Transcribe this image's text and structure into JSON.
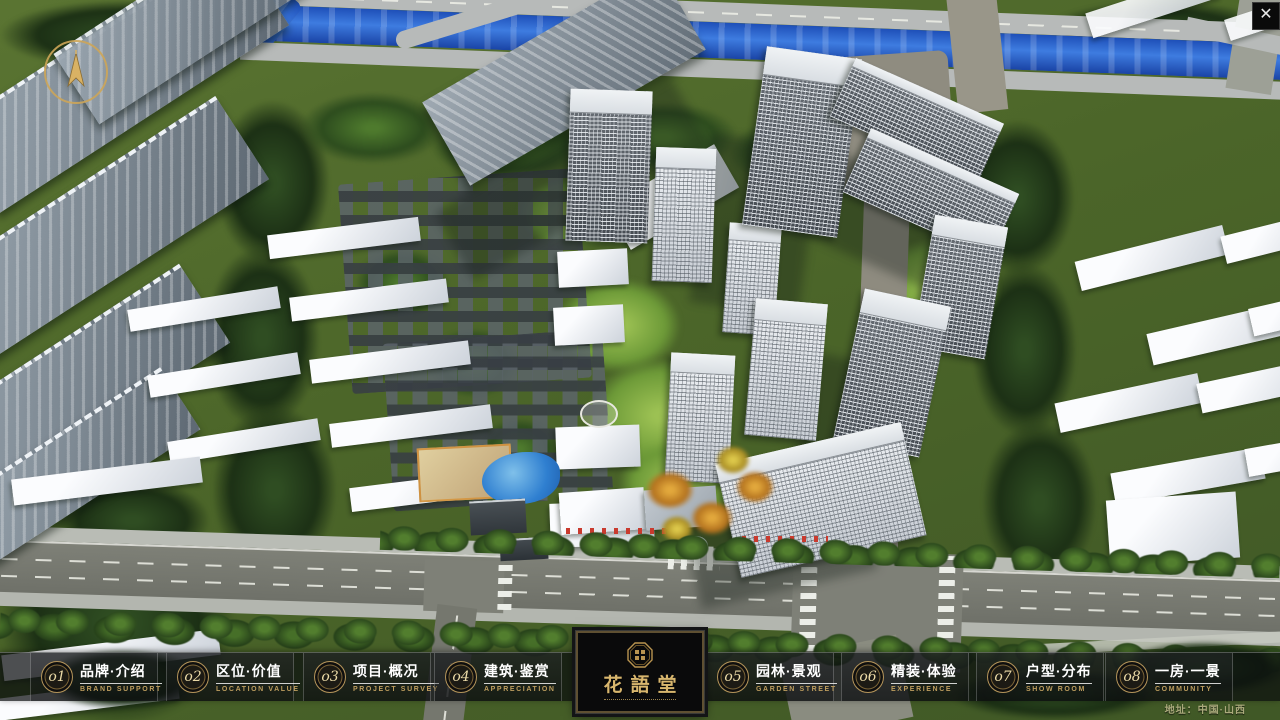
{
  "app": {
    "close_glyph": "✕",
    "address": "地址：中国·山西"
  },
  "logo": {
    "name": "花語堂"
  },
  "navbar": {
    "items": [
      {
        "num": "o1",
        "zh": "品牌·介绍",
        "en": "BRAND SUPPORT"
      },
      {
        "num": "o2",
        "zh": "区位·价值",
        "en": "LOCATION VALUE"
      },
      {
        "num": "o3",
        "zh": "项目·概况",
        "en": "PROJECT SURVEY"
      },
      {
        "num": "o4",
        "zh": "建筑·鉴赏",
        "en": "APPRECIATION"
      },
      {
        "num": "o5",
        "zh": "园林·景观",
        "en": "GARDEN STREET"
      },
      {
        "num": "o6",
        "zh": "精装·体验",
        "en": "EXPERIENCE"
      },
      {
        "num": "o7",
        "zh": "户型·分布",
        "en": "SHOW ROOM"
      },
      {
        "num": "o8",
        "zh": "一房·一景",
        "en": "COMMUNITY"
      }
    ]
  },
  "colors": {
    "accent_gold": "#c2a05e",
    "bar_bg": "rgba(10,12,14,0.72)",
    "river_blue": "#2b62cf"
  }
}
